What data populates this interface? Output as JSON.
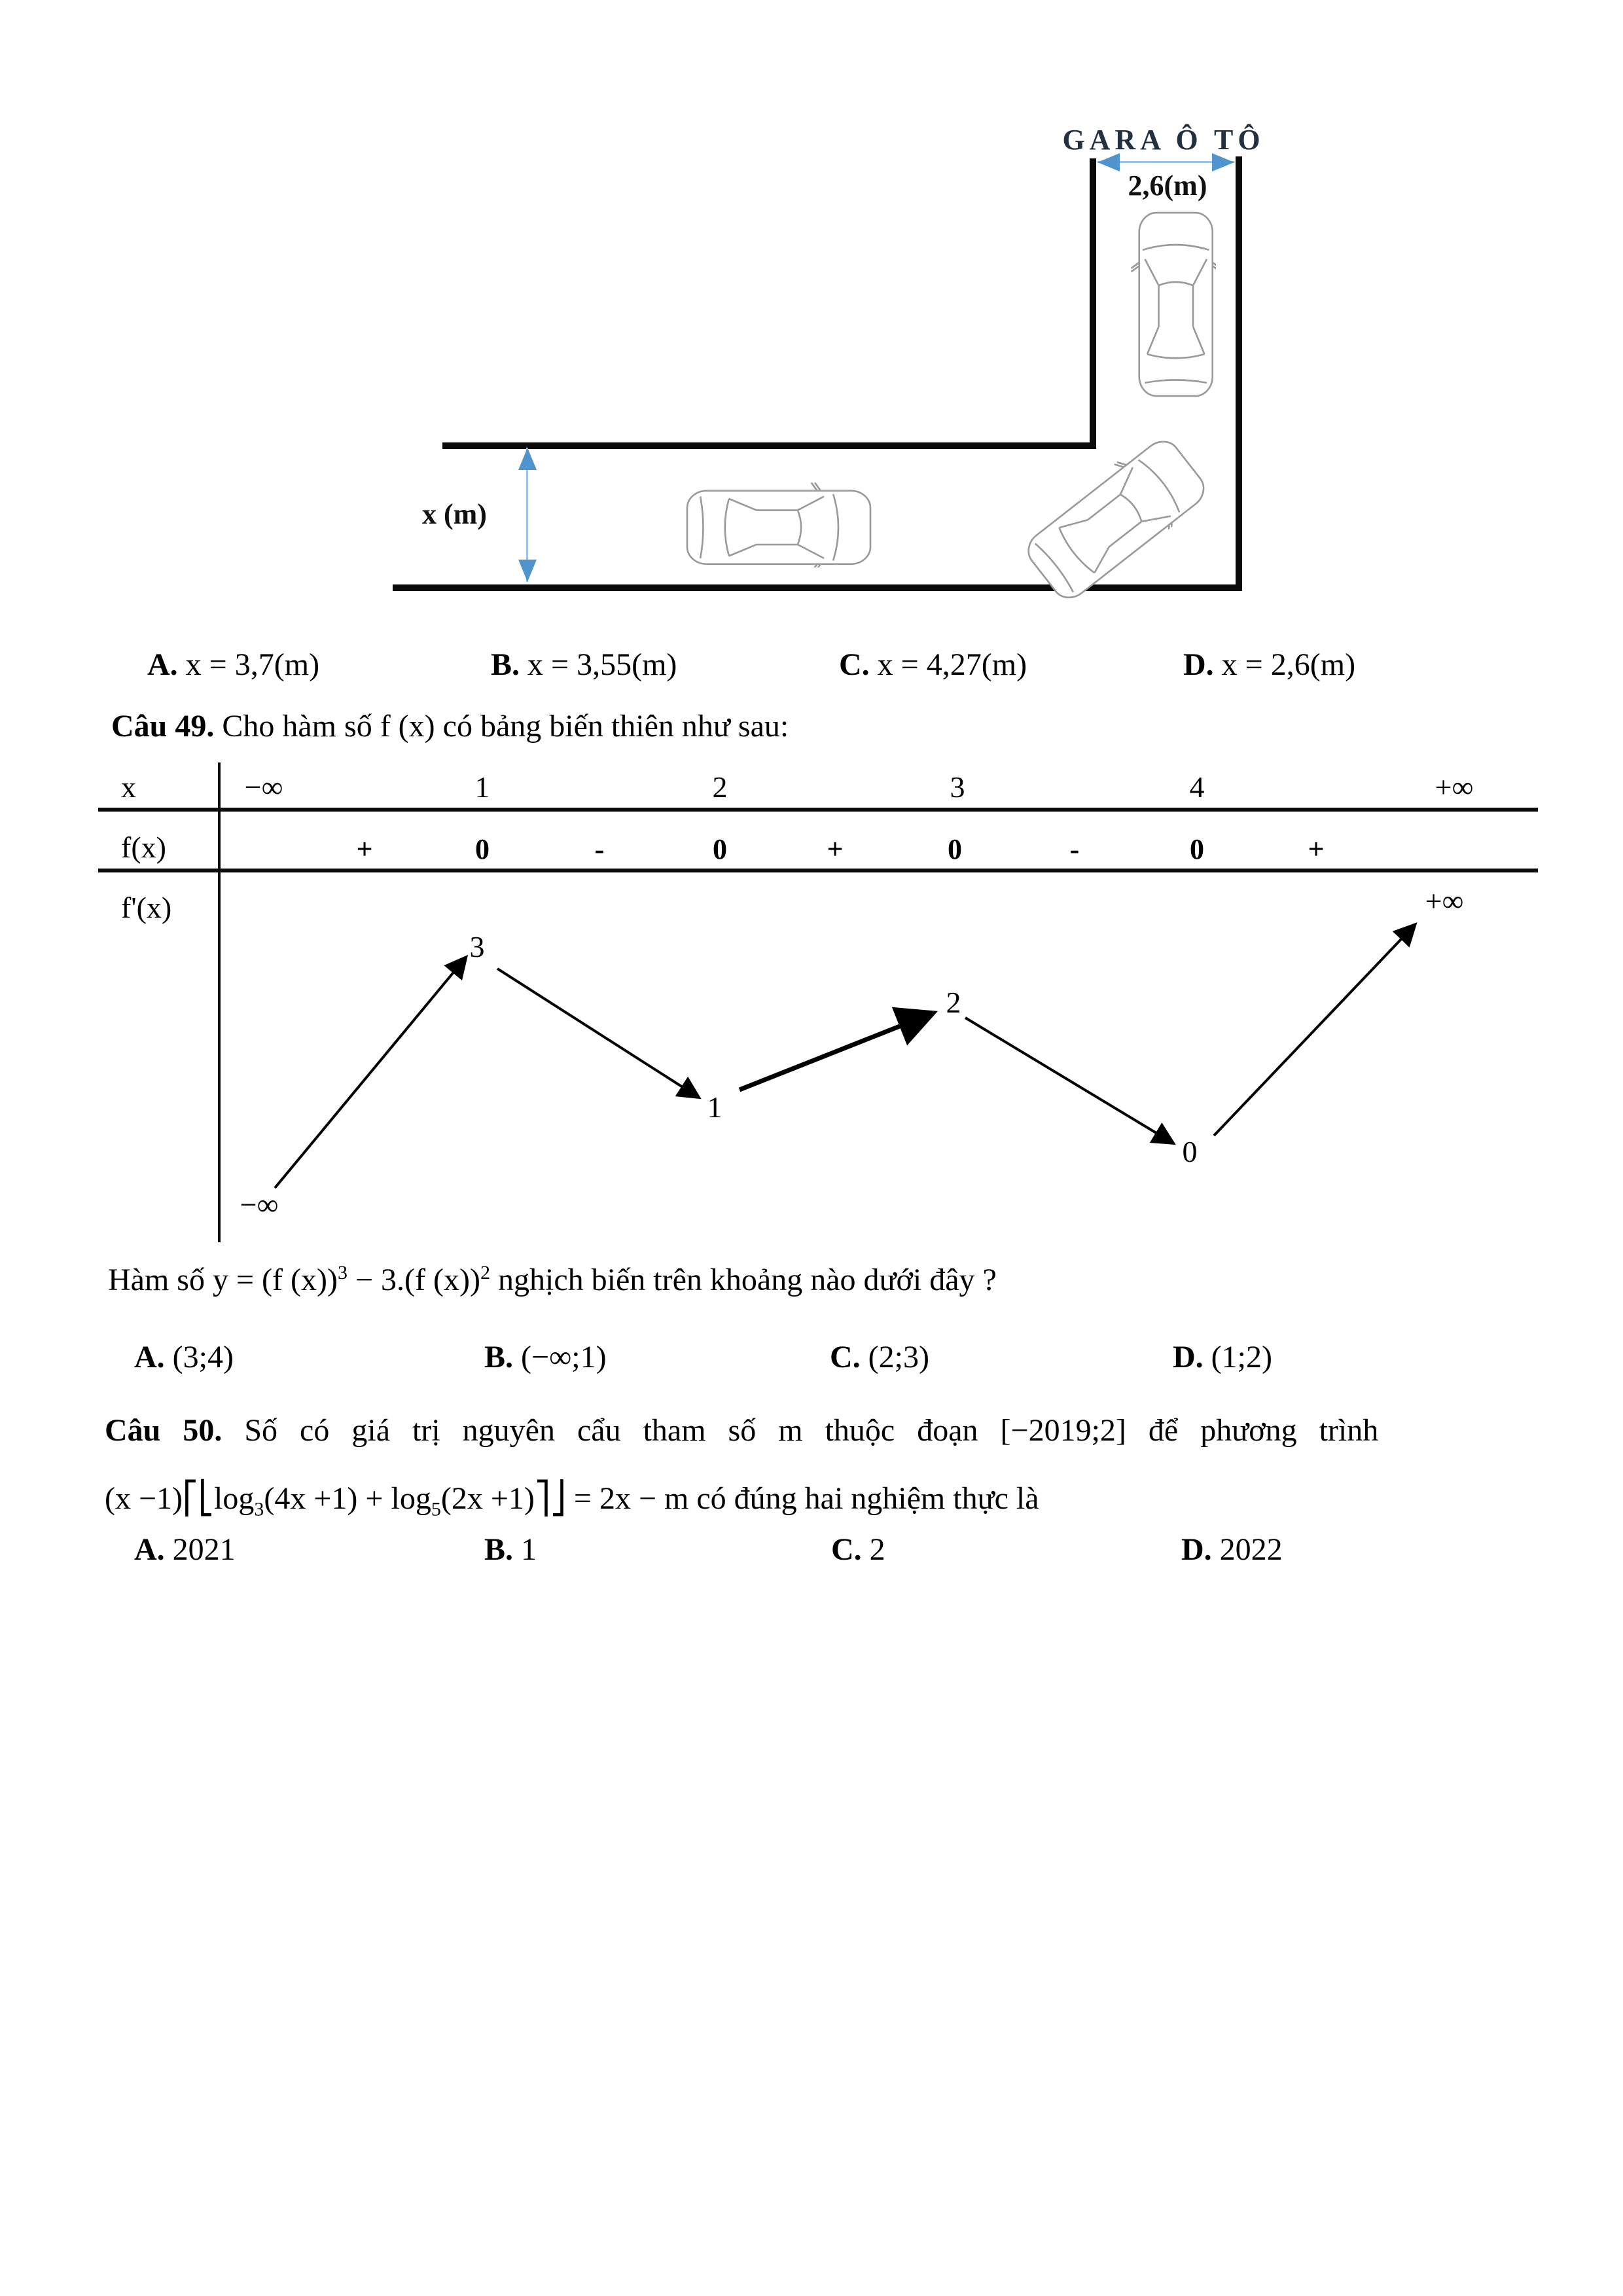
{
  "diagram": {
    "garage_label": "GARA Ô TÔ",
    "garage_width_label": "2,6(m)",
    "corridor_width_label": "x (m)",
    "accent_color": "#4f94cd"
  },
  "q48": {
    "options": [
      {
        "letter": "A.",
        "text": "x = 3,7(m)"
      },
      {
        "letter": "B.",
        "text": "x = 3,55(m)"
      },
      {
        "letter": "C.",
        "text": "x = 4,27(m)"
      },
      {
        "letter": "D.",
        "text": "x = 2,6(m)"
      }
    ]
  },
  "q49": {
    "number": "Câu 49.",
    "intro": " Cho hàm số f (x) có bảng biến thiên như sau:",
    "table": {
      "row_labels": [
        "x",
        "f(x)",
        "f'(x)"
      ],
      "x_values": [
        "−∞",
        "1",
        "2",
        "3",
        "4",
        "+∞"
      ],
      "signs": [
        "+",
        "0",
        "-",
        "0",
        "+",
        "0",
        "-",
        "0",
        "+"
      ],
      "curve_values": [
        "−∞",
        "3",
        "1",
        "2",
        "0",
        "+∞"
      ]
    },
    "question": {
      "prefix": "Hàm số ",
      "f1": "y = (f (x))",
      "sup1": "3",
      "mid": " − 3.(f (x))",
      "sup2": "2",
      "suffix": " nghịch biến trên khoảng nào dưới đây ?"
    },
    "options": [
      {
        "letter": "A.",
        "text": "(3;4)"
      },
      {
        "letter": "B.",
        "text": "(−∞;1)"
      },
      {
        "letter": "C.",
        "text": "(2;3)"
      },
      {
        "letter": "D.",
        "text": "(1;2)"
      }
    ]
  },
  "q50": {
    "number": "Câu 50.",
    "line1_a": "Số có giá trị nguyên cẩu tham số m thuộc đoạn",
    "interval": "[−2019;2]",
    "line1_b": "để phương trình",
    "eq1": "(x −1)⎡⎣log",
    "sub1": "3",
    "eq2": "(4x +1) + log",
    "sub2": "5",
    "eq3": "(2x +1)⎤⎦ = 2x − m",
    "eq_tail": " có đúng hai nghiệm thực là",
    "options": [
      {
        "letter": "A.",
        "text": "2021"
      },
      {
        "letter": "B.",
        "text": "1"
      },
      {
        "letter": "C.",
        "text": "2"
      },
      {
        "letter": "D.",
        "text": "2022"
      }
    ]
  }
}
